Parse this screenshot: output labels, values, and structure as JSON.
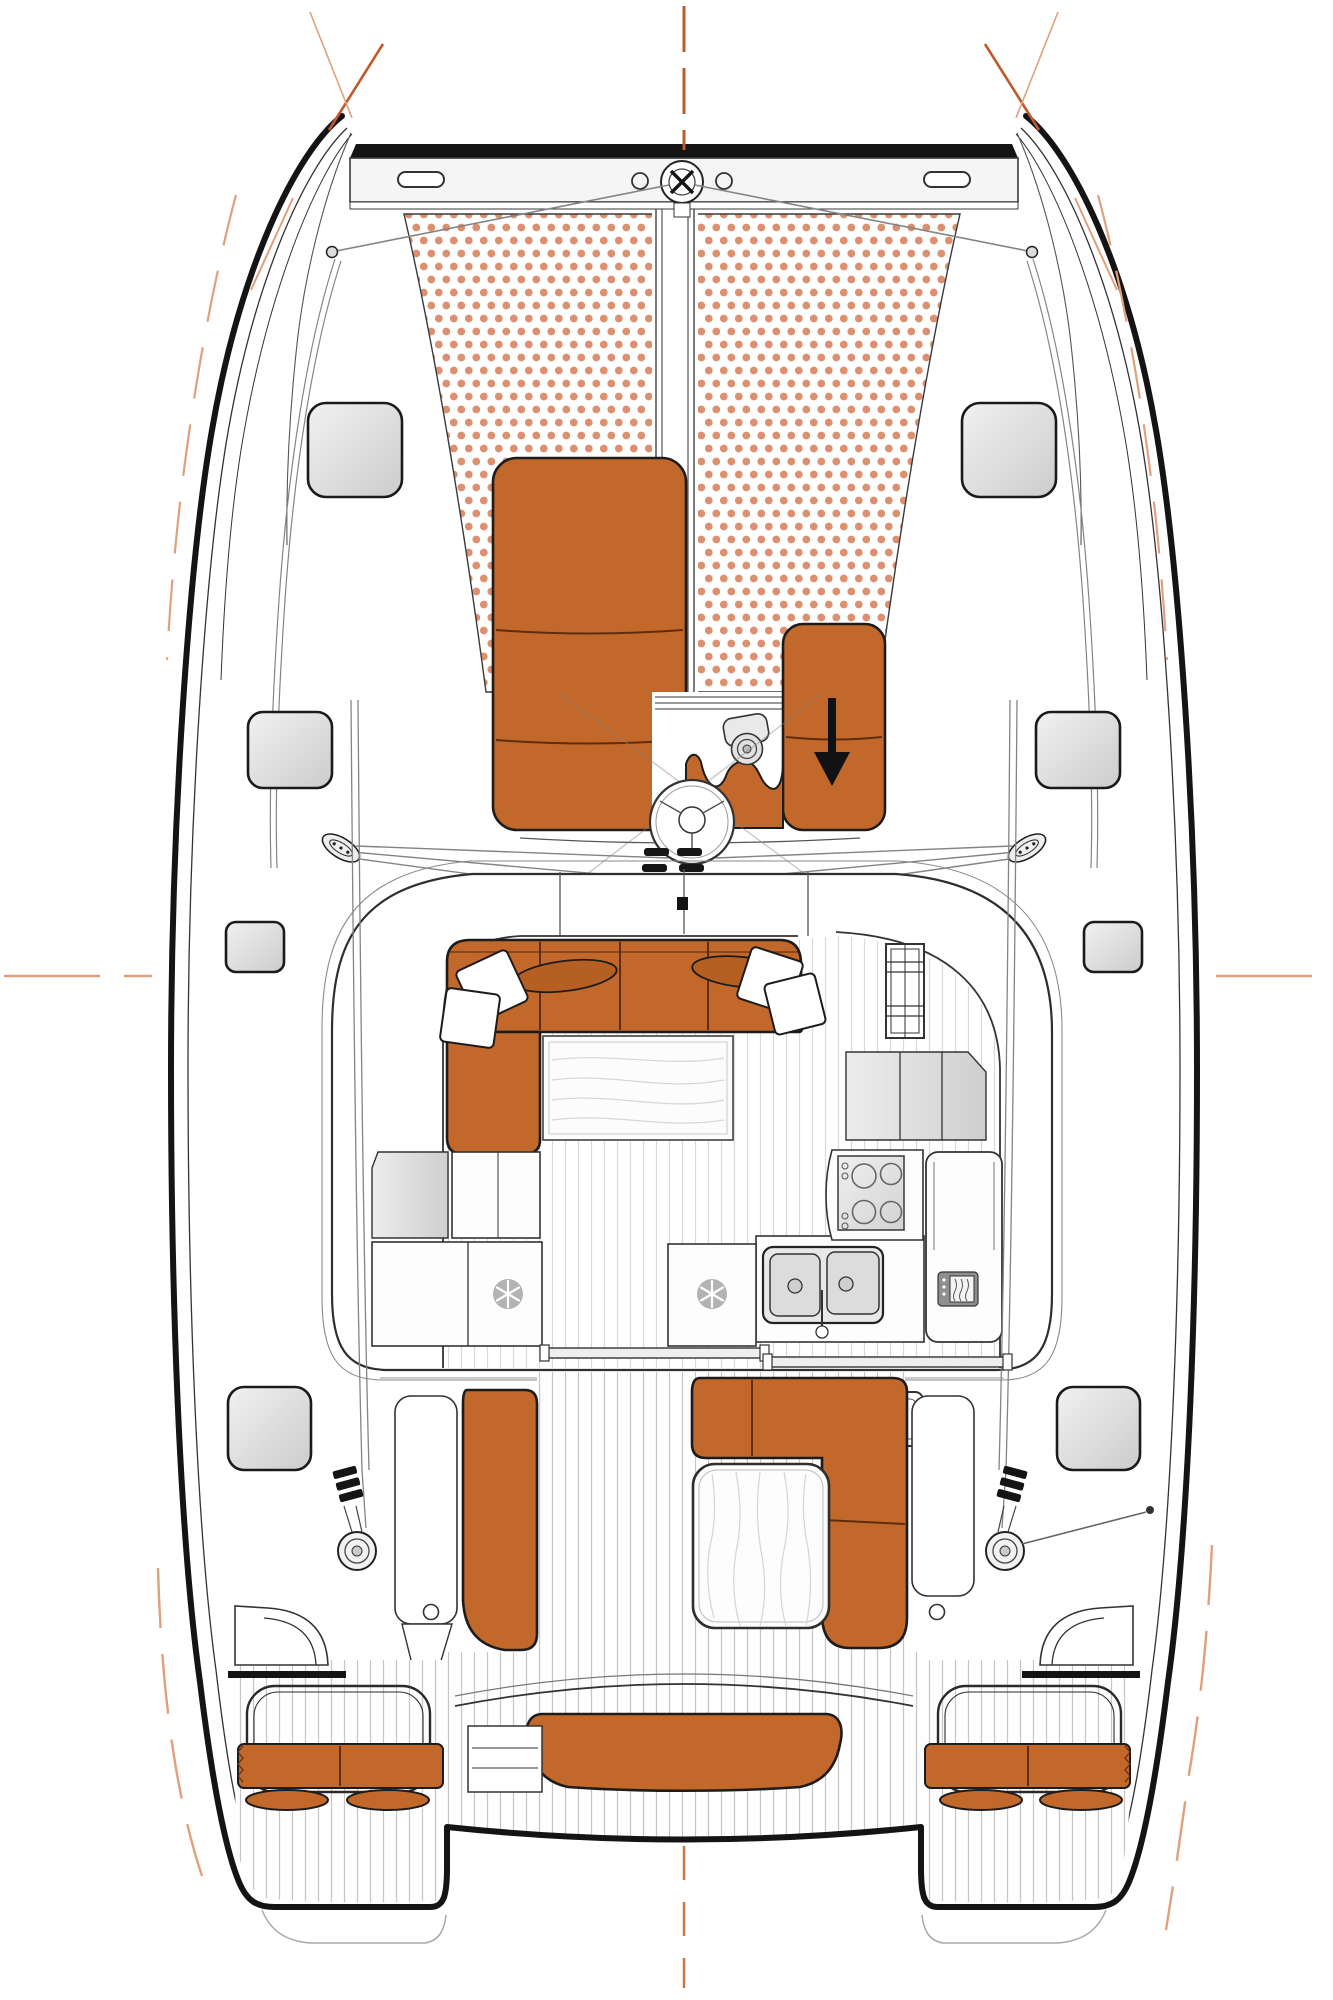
{
  "diagram": {
    "type": "boat-deck-plan",
    "subject": "catamaran-layout-top-view",
    "visible_text": [],
    "colors": {
      "bg": "#ffffff",
      "orange": "#C2682A",
      "orange-dark": "#B65F22",
      "seam": "#5f2d0e",
      "outline": "#1c1c1c",
      "heavy": "#141414",
      "line": "#333333",
      "rig": "#848484",
      "dot": "#DC9070",
      "plank": "#d9d9d9",
      "plank-dark": "#c6c6c6",
      "mark-strong": "#C05A2A",
      "mark-light": "#E0A07C",
      "snowflake-disc": "#b3b3b3",
      "wood-grain": "#d6d6d6"
    },
    "icons": [
      {
        "name": "snowflake-icon",
        "meaning": "refrigerator / freezer",
        "count": 2
      },
      {
        "name": "down-arrow-icon",
        "meaning": "access / opening direction on sunpad locker"
      },
      {
        "name": "windlass-icon",
        "meaning": "anchor windlass on forward beam"
      },
      {
        "name": "windlass-motor-icon",
        "meaning": "anchor windlass motor in locker"
      },
      {
        "name": "mast-icon",
        "meaning": "mast base circle"
      },
      {
        "name": "winch-icon",
        "meaning": "cockpit winch",
        "count": 2
      },
      {
        "name": "stove-icon",
        "meaning": "4-burner galley stove"
      },
      {
        "name": "double-sink-icon",
        "meaning": "galley twin sink"
      },
      {
        "name": "microwave-icon",
        "meaning": "microwave oven in tall cabinet"
      },
      {
        "name": "registration-cross-icon",
        "meaning": "print registration crosshair",
        "count": 2
      }
    ],
    "features": [
      "port-hull",
      "starboard-hull",
      "forward-crossbeam",
      "trampoline-with-dots",
      "anchor-channel",
      "forward-sunpad",
      "side-sunpad-with-arrow",
      "anchor-locker",
      "mast-base",
      "rope-clutch-banks",
      "standing-rigging-lines",
      "deck-hatches-8",
      "coachroof",
      "saloon-l-sofa",
      "throw-pillows-4",
      "saloon-table",
      "galley-counters",
      "fridge-2",
      "stove",
      "double-sink",
      "microwave-cabinet",
      "sliding-door-tracks",
      "cockpit-floor-teak",
      "cockpit-bench-port",
      "cockpit-bench-starboard-L",
      "cockpit-table",
      "winches-and-clutches",
      "aft-sunbench-center",
      "transom-platforms",
      "transom-rails",
      "transom-cushions",
      "registration-marks",
      "centerline-dashes"
    ]
  }
}
